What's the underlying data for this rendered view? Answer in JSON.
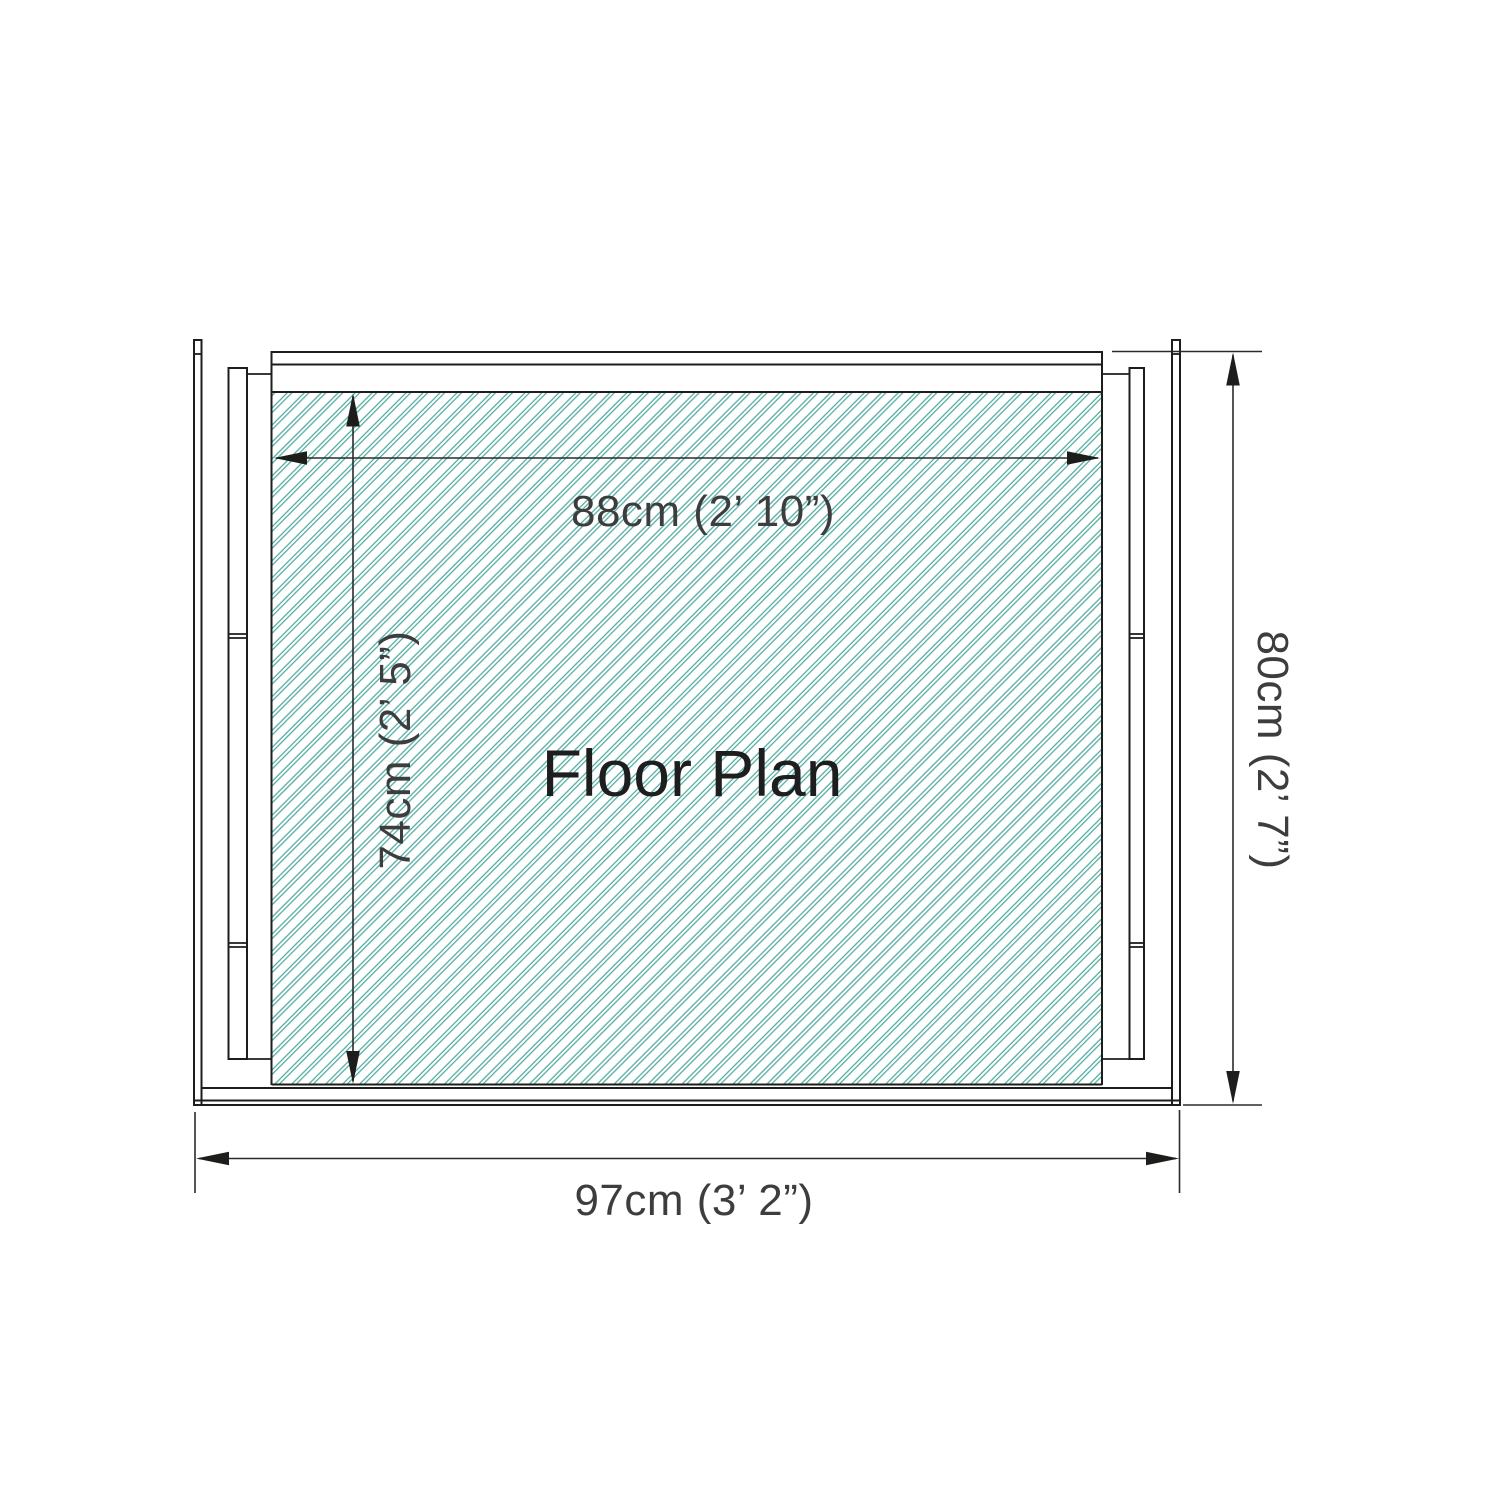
{
  "drawing": {
    "title": "Floor Plan",
    "dimensions": {
      "inner_width": "88cm (2’ 10”)",
      "inner_depth": "74cm (2’ 5”)",
      "outer_height": "80cm (2’ 7”)",
      "outer_width": "97cm (3’ 2”)"
    },
    "colors": {
      "hatch": "#4fab9f",
      "wall_line": "#1d1d1b",
      "dim_text": "#3d3d3d",
      "title_text": "#1e1e1e",
      "background": "#ffffff"
    }
  }
}
